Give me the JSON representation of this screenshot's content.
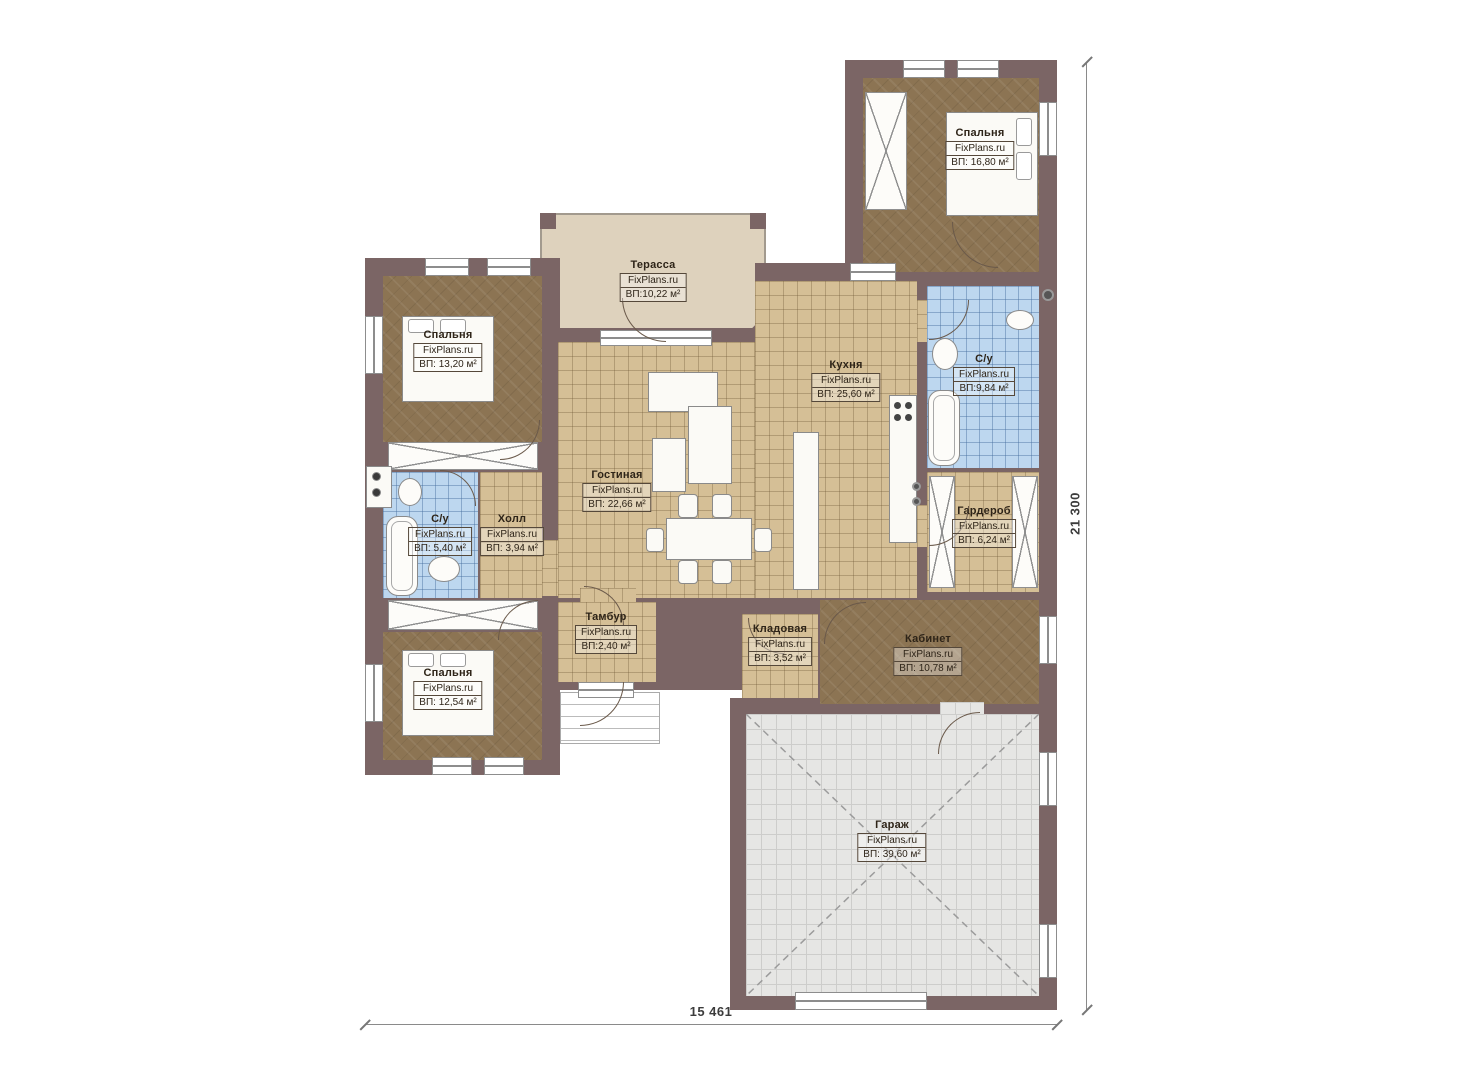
{
  "plan": {
    "watermark": "FixPlans.ru",
    "rooms": {
      "terrace": {
        "name": "Терасса",
        "area": "ВП:10,22 м²"
      },
      "bedroom_top_left": {
        "name": "Спальня",
        "area": "ВП: 13,20 м²"
      },
      "bedroom_top_right": {
        "name": "Спальня",
        "area": "ВП: 16,80 м²"
      },
      "bedroom_bottom_left": {
        "name": "Спальня",
        "area": "ВП: 12,54 м²"
      },
      "kitchen": {
        "name": "Кухня",
        "area": "ВП: 25,60 м²"
      },
      "living_room": {
        "name": "Гостиная",
        "area": "ВП: 22,66 м²"
      },
      "hall": {
        "name": "Холл",
        "area": "ВП: 3,94 м²"
      },
      "bathroom_left": {
        "name": "С/у",
        "area": "ВП: 5,40 м²"
      },
      "bathroom_right": {
        "name": "С/у",
        "area": "ВП:9,84 м²"
      },
      "wardrobe": {
        "name": "Гардероб",
        "area": "ВП: 6,24 м²"
      },
      "vestibule": {
        "name": "Тамбур",
        "area": "ВП:2,40 м²"
      },
      "storage": {
        "name": "Кладовая",
        "area": "ВП: 3,52 м²"
      },
      "office": {
        "name": "Кабинет",
        "area": "ВП: 10,78 м²"
      },
      "garage": {
        "name": "Гараж",
        "area": "ВП: 39,60 м²"
      }
    },
    "dimensions": {
      "width_label": "15 461",
      "height_label": "21 300"
    }
  }
}
